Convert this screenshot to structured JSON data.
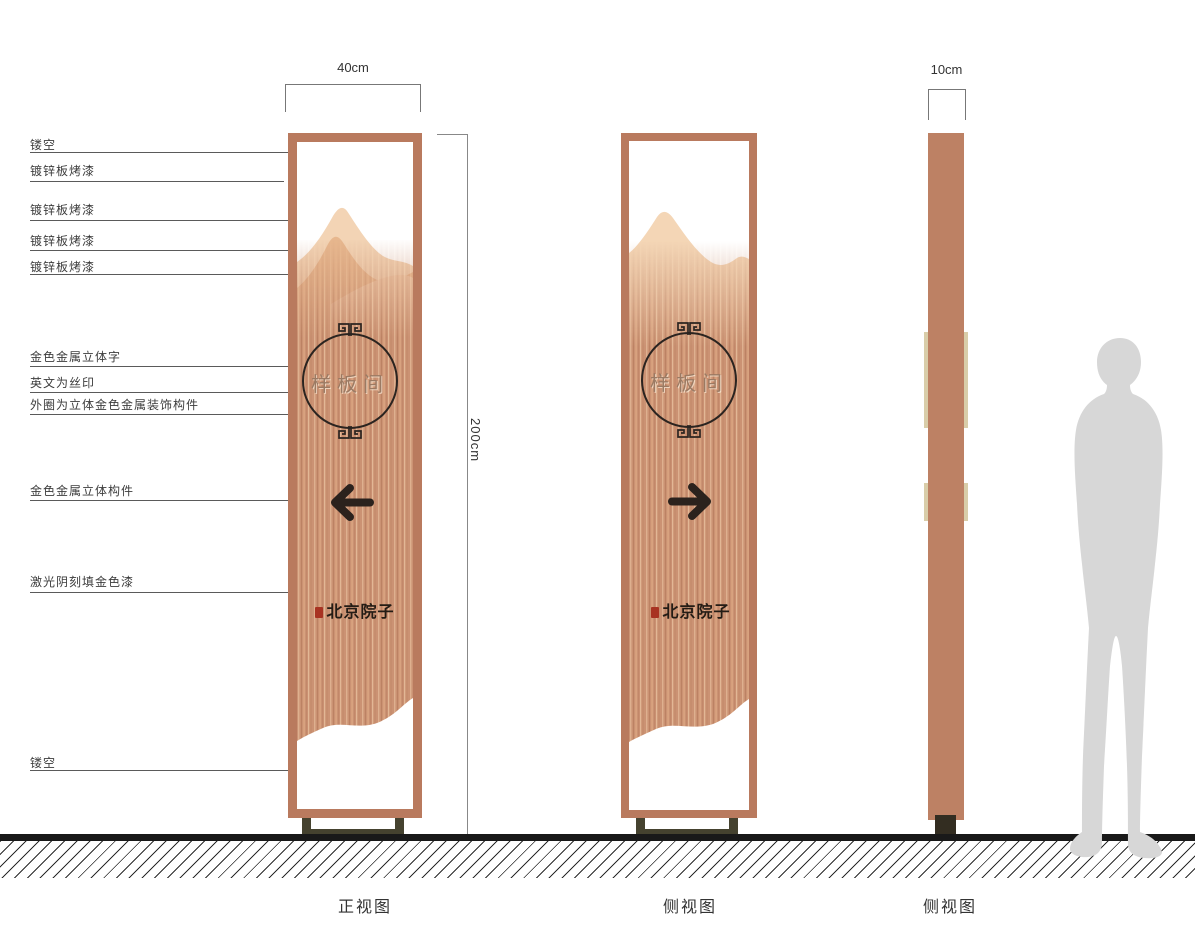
{
  "dimensions": {
    "width_front": "40cm",
    "height": "200cm",
    "width_side": "10cm"
  },
  "callouts": [
    {
      "label": "镂空"
    },
    {
      "label": "镀锌板烤漆"
    },
    {
      "label": "镀锌板烤漆"
    },
    {
      "label": "镀锌板烤漆"
    },
    {
      "label": "镀锌板烤漆"
    },
    {
      "label": "金色金属立体字"
    },
    {
      "label": "英文为丝印"
    },
    {
      "label": "外圈为立体金色金属装饰构件"
    },
    {
      "label": "金色金属立体构件"
    },
    {
      "label": "激光阴刻填金色漆"
    },
    {
      "label": "镂空"
    }
  ],
  "sign": {
    "room_label": "样板间",
    "brand_label": "北京院子"
  },
  "captions": {
    "front": "正视图",
    "side": "侧视图",
    "profile": "侧视图"
  },
  "colors": {
    "frame_copper": "#b97a5e",
    "panel_base": "#cb9273",
    "mountain_light": "#f3d4b5",
    "mountain_mid": "#e7b78e",
    "ink": "#2b2420",
    "gold_text": "#9b7a63",
    "seal_red": "#a83322",
    "base_foot": "#45422f",
    "silhouette_gray": "#d7d7d7"
  }
}
